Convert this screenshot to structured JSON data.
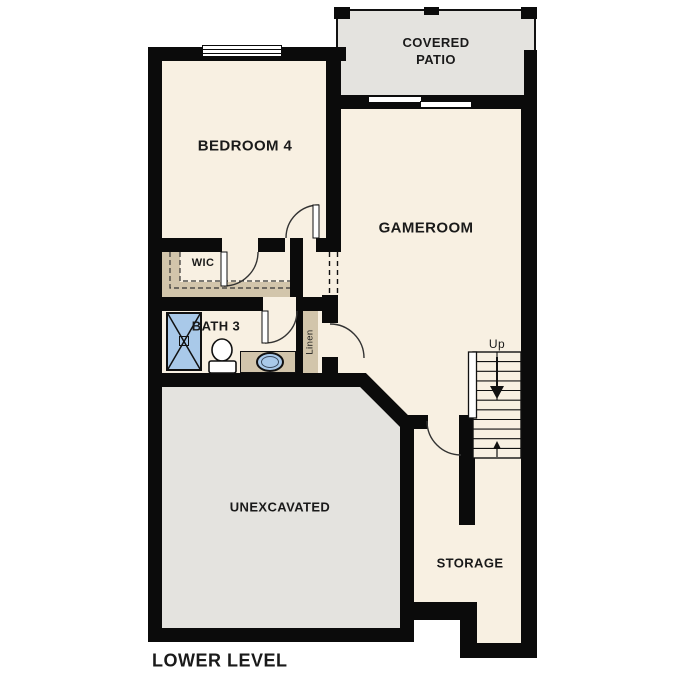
{
  "title": "LOWER LEVEL",
  "rooms": {
    "covered_patio": "COVERED PATIO",
    "bedroom_4": "BEDROOM 4",
    "gameroom": "GAMEROOM",
    "wic": "WIC",
    "bath_3": "BATH 3",
    "linen": "Linen",
    "unexcavated": "UNEXCAVATED",
    "storage": "STORAGE"
  },
  "stairs": {
    "direction_label": "Up"
  },
  "colors": {
    "wall": "#0b0b0b",
    "floor": "#f8f0e2",
    "exterior_area": "#e4e3df",
    "casework_tan": "#d2c5ab",
    "fixture_blue": "#a9c9e9",
    "background": "#ffffff",
    "text": "#1a1a1a"
  }
}
